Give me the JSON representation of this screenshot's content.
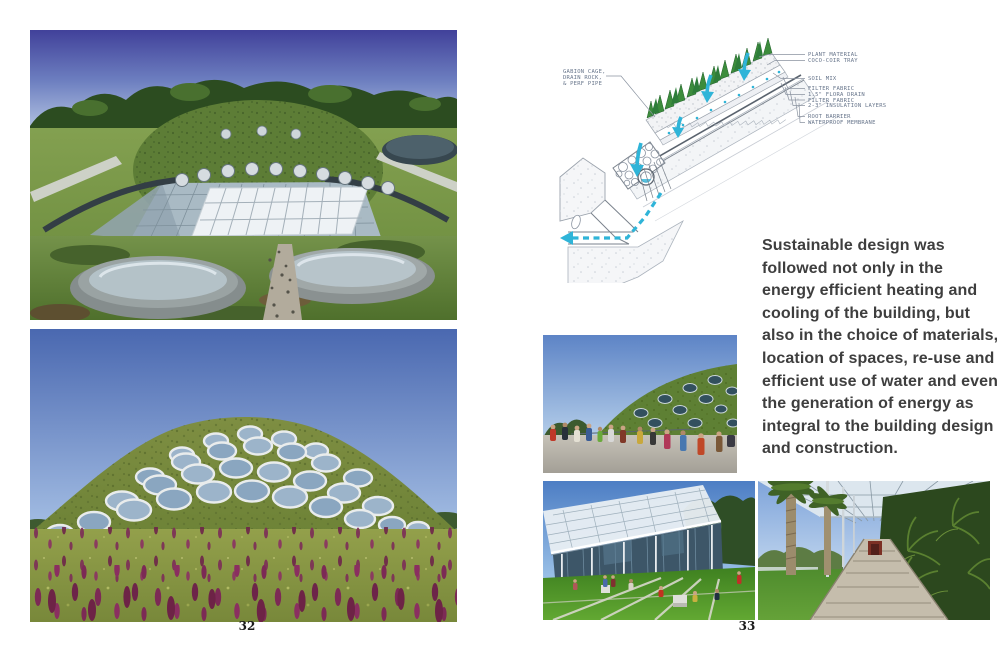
{
  "page": {
    "background": "#ffffff",
    "left_number": "32",
    "right_number": "33"
  },
  "text_block": {
    "paragraph": "Sustainable design was\nfollowed not only in the\nenergy efficient heating and\ncooling of the building, but\nalso in the choice of materials,\nlocation of spaces, re-use and\nefficient use of water and even\nthe generation of energy as\nintegral to the building design\nand construction.",
    "color": "#3e3e3e"
  },
  "diagram": {
    "description": "hand-drawn section detail of the living roof drainage build-up",
    "gabion_label": "GABION CAGE,\nDRAIN ROCK,\n& PERF PIPE",
    "labels": [
      "PLANT MATERIAL",
      "COCO-COIR TRAY",
      "SOIL MIX",
      "FILTER FABRIC",
      "1.5\" FLORA DRAIN",
      "FILTER FABRIC",
      "2-3\" INSULATION LAYERS",
      "ROOT BARRIER",
      "WATERPROOF MEMBRANE"
    ],
    "water_color": "#2fb4d8",
    "ink_color": "#8a93a0"
  },
  "photos": {
    "top_left": {
      "description": "living roof with central glass atrium skylight and two round skylight drums"
    },
    "bottom_left": {
      "description": "green roof dome with circular porthole skylights above a wildflower meadow"
    },
    "visitors": {
      "description": "visitors queueing beside the living roof dome"
    },
    "lawn": {
      "description": "glass facade with white canopy and visitors seated on the lawn"
    },
    "walkway": {
      "description": "covered colonnade walkway between palm trees and tree ferns"
    }
  }
}
